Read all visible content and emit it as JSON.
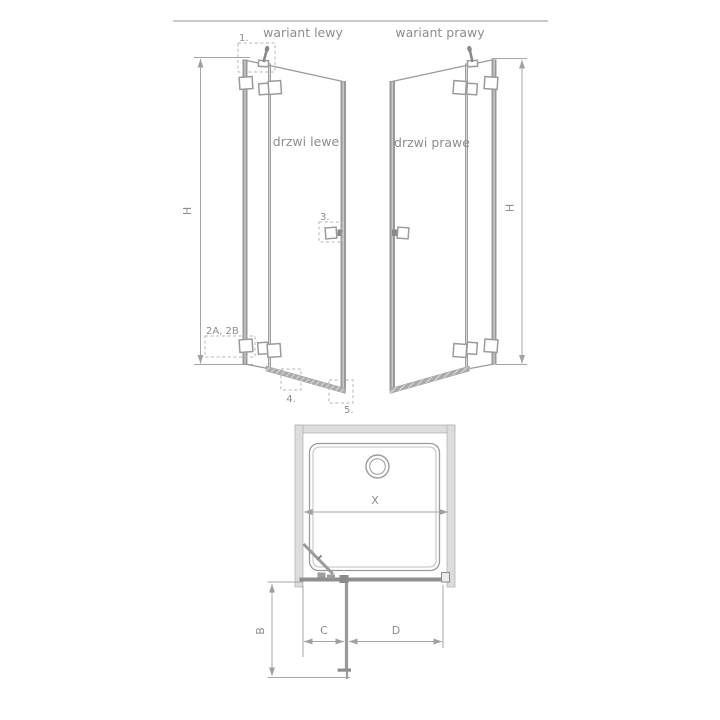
{
  "left_elevation": {
    "label": "wariant lewy",
    "door_text": "drzwi lewe",
    "height_dim_label": "H",
    "callouts": {
      "top_hinge": "1.",
      "bottom_hinges": "2A, 2B",
      "handle": "3.",
      "bottom_rail": "4.",
      "corner": "5."
    }
  },
  "right_elevation": {
    "label": "wariant prawy",
    "door_text": "drzwi prawe",
    "height_dim_label": "H"
  },
  "plan": {
    "width_label": "X",
    "projection_label": "B",
    "left_segment_label": "C",
    "door_width_label": "D"
  },
  "colors": {
    "background": "#ffffff",
    "line": "#9b9b9b",
    "text": "#8d8d8d",
    "dim": "#a6a6a6",
    "profile": "#999999",
    "wall_fill": "#dcdcdc"
  }
}
